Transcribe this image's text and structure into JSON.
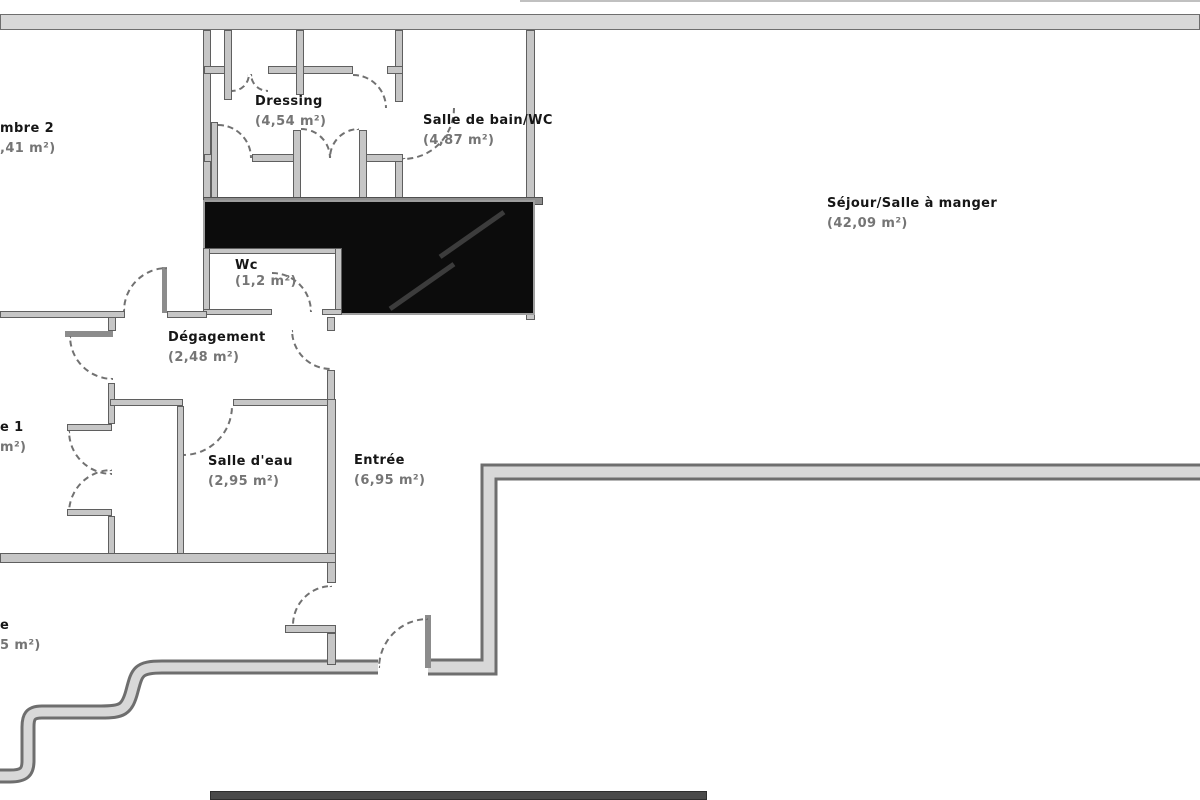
{
  "plan": {
    "type_label": "floor-plan",
    "language": "fr",
    "colors": {
      "wall_fill": "#d8d8d8",
      "wall_edge": "#6e6e6e",
      "partition_fill": "#c6c6c6",
      "shaft_black": "#0c0c0c",
      "door_arc_dash": "#717171",
      "room_name_text": "#161616",
      "room_area_text": "#757575",
      "background": "#ffffff"
    }
  },
  "rooms": {
    "chambre2": {
      "name": "mbre 2",
      "area": ",41 m²)",
      "truncated_left_edge": "yes"
    },
    "dressing": {
      "name": "Dressing",
      "area": "(4,54 m²)"
    },
    "salle_de_bain": {
      "name": "Salle de bain/WC",
      "area": "(4,87 m²)"
    },
    "sejour": {
      "name": "Séjour/Salle à manger",
      "area": "(42,09 m²)"
    },
    "wc": {
      "name": "Wc",
      "area": "(1,2 m²)"
    },
    "degagement": {
      "name": "Dégagement",
      "area": "(2,48 m²)"
    },
    "salle_deau": {
      "name": "Salle d'eau",
      "area": "(2,95 m²)"
    },
    "entree": {
      "name": "Entrée",
      "area": "(6,95 m²)"
    },
    "chambre1": {
      "name": "e 1",
      "area": "m²)",
      "truncated_left_edge": "yes"
    },
    "piece_bas": {
      "name": "e",
      "area": "5 m²)",
      "truncated_left_edge": "yes"
    }
  }
}
